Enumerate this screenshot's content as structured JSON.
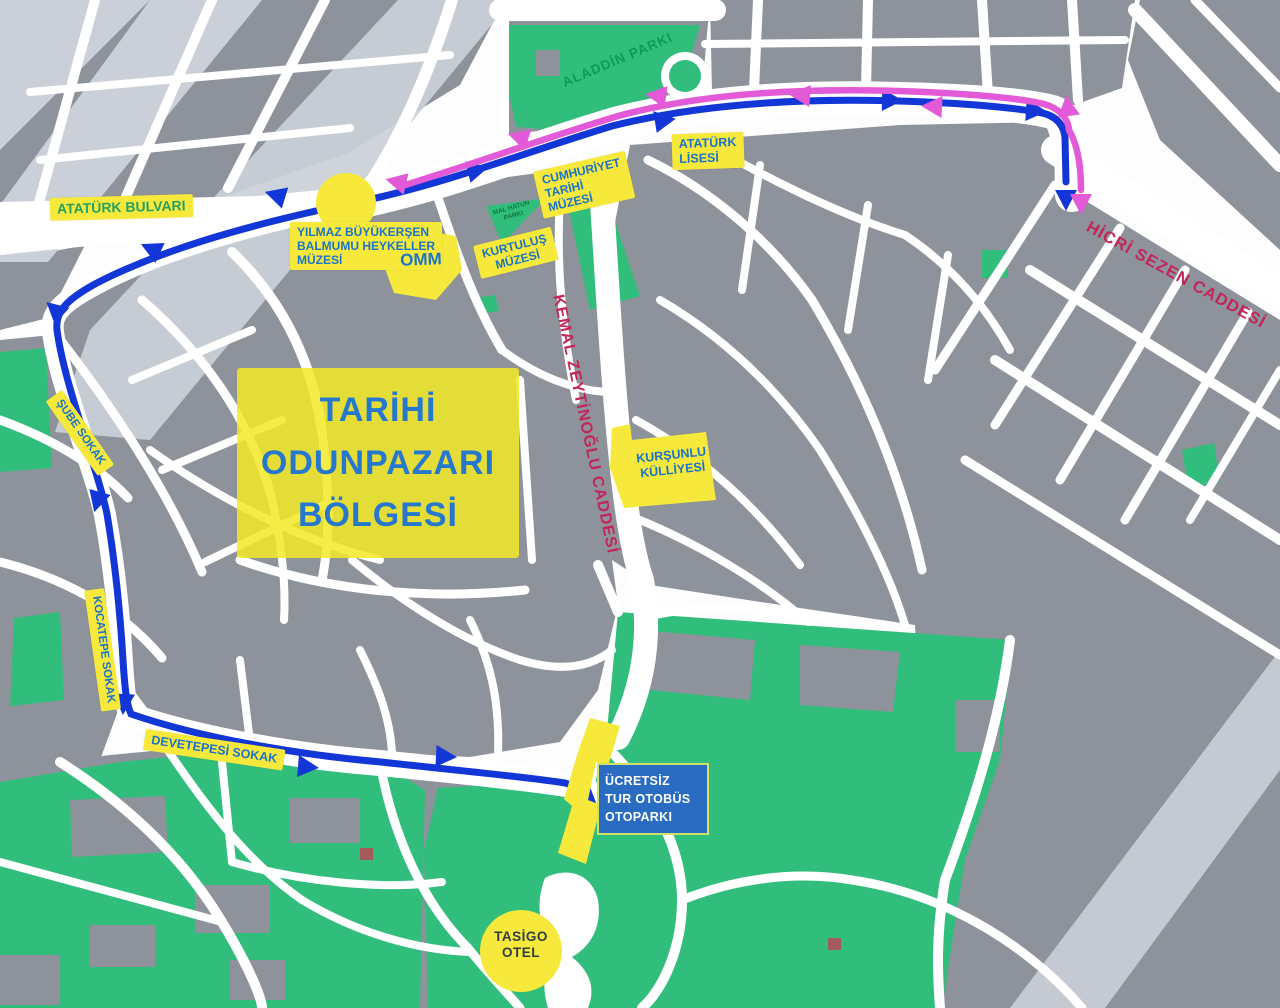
{
  "map_title": "Tarihi Odunpazari tour route map",
  "region": {
    "lines": [
      "TARİHİ",
      "ODUNPAZARI",
      "BÖLGESİ"
    ]
  },
  "parks": {
    "aladdin": "ALADDİN PARKI",
    "mal_hatun": {
      "lines": [
        "MAL HATUN",
        "PARKI"
      ]
    }
  },
  "streets": {
    "ataturk_bulvari": "ATATÜRK BULVARI",
    "sube": "ŞUBE SOKAK",
    "kocatepe": "KOCATEPE SOKAK",
    "devetepesi": "DEVETEPESİ SOKAK",
    "kemal_zeytinoglu": "KEMAL ZEYTİNOĞLU CADDESİ",
    "hicri_sezen": "HİCRİ SEZEN CADDESİ"
  },
  "pois": {
    "yilmaz": {
      "lines": [
        "YILMAZ BÜYÜKERŞEN",
        "BALMUMU HEYKELLER",
        "MÜZESİ"
      ]
    },
    "omm": "OMM",
    "kurtulus": {
      "lines": [
        "KURTULUŞ",
        "MÜZESİ"
      ]
    },
    "cumhuriyet": {
      "lines": [
        "CUMHURİYET",
        "TARİHİ",
        "MÜZESİ"
      ]
    },
    "ataturk_lisesi": {
      "lines": [
        "ATATÜRK",
        "LİSESİ"
      ]
    },
    "kursunlu": {
      "lines": [
        "KURŞUNLU",
        "KÜLLİYESİ"
      ]
    },
    "bus_parking": {
      "lines": [
        "ÜCRETSİZ",
        "TUR OTOBÜS",
        "OTOPARKI"
      ]
    },
    "tasigo": {
      "lines": [
        "TASİGO",
        "OTEL"
      ]
    }
  },
  "colors": {
    "route_outbound_blue": "#1337d6",
    "route_return_magenta": "#e35ad8",
    "park_green": "#31bd7c",
    "block_gray": "#8e939b",
    "light_band_gray": "#cbd0d8",
    "label_yellow": "#f6e93c",
    "label_text_blue": "#1b74c9",
    "street_name_red": "#c32558",
    "park_name_green": "#0d9b55",
    "bus_box_blue": "#2b6cc3",
    "bus_box_border": "#cfe169"
  }
}
